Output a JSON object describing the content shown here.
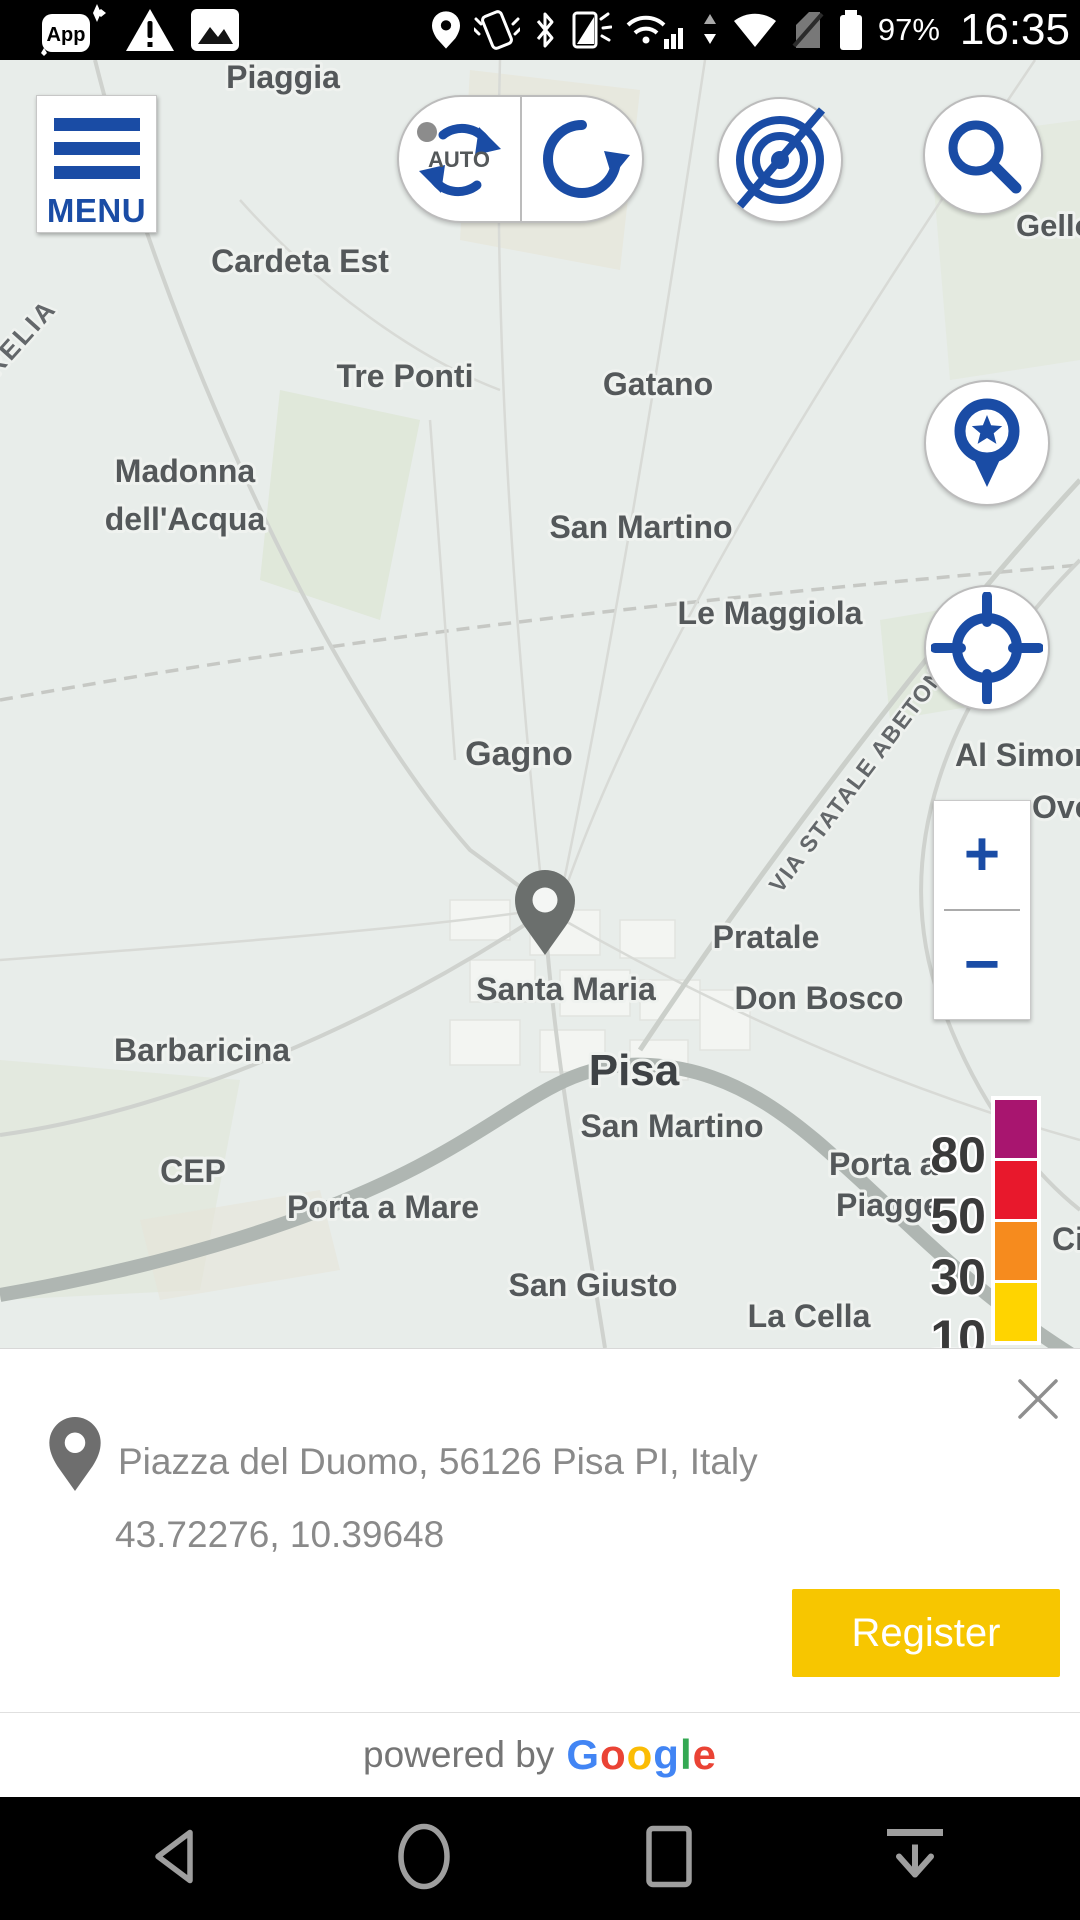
{
  "status_bar": {
    "time": "16:35",
    "battery_percent": "97%"
  },
  "map_controls": {
    "menu_label": "MENU",
    "auto_label": "AUTO",
    "zoom_in_label": "+",
    "zoom_out_label": "−"
  },
  "map": {
    "labels": [
      {
        "text": "Piaggia",
        "x": 283,
        "y": 28,
        "size": 32
      },
      {
        "text": "Gello",
        "x": 1016,
        "y": 176,
        "size": 31,
        "anchor": "start"
      },
      {
        "text": "Cardeta Est",
        "x": 300,
        "y": 212,
        "size": 32
      },
      {
        "text": "RELIA",
        "x": -4,
        "y": 318,
        "size": 26,
        "rotate": -48,
        "anchor": "start",
        "cls": "lbl-road",
        "spacing": "3"
      },
      {
        "text": "Tre Ponti",
        "x": 405,
        "y": 327,
        "size": 32
      },
      {
        "text": "Gatano",
        "x": 658,
        "y": 335,
        "size": 32
      },
      {
        "text": "Madonna",
        "x": 185,
        "y": 422,
        "size": 32
      },
      {
        "text": "dell'Acqua",
        "x": 185,
        "y": 470,
        "size": 32
      },
      {
        "text": "San Martino",
        "x": 641,
        "y": 478,
        "size": 32
      },
      {
        "text": "Le Maggiola",
        "x": 770,
        "y": 564,
        "size": 32
      },
      {
        "text": "Gagno",
        "x": 519,
        "y": 705,
        "size": 34
      },
      {
        "text": "VIA STATALE ABETONE",
        "x": 868,
        "y": 718,
        "size": 23,
        "rotate": -53,
        "cls": "lbl-road",
        "spacing": "1.5"
      },
      {
        "text": "Al Simon",
        "x": 955,
        "y": 706,
        "size": 32,
        "anchor": "start"
      },
      {
        "text": "Ovest",
        "x": 1032,
        "y": 758,
        "size": 32,
        "anchor": "start"
      },
      {
        "text": "Pratale",
        "x": 766,
        "y": 888,
        "size": 32
      },
      {
        "text": "Santa Maria",
        "x": 566,
        "y": 940,
        "size": 32
      },
      {
        "text": "Don Bosco",
        "x": 819,
        "y": 949,
        "size": 32
      },
      {
        "text": "Barbaricina",
        "x": 202,
        "y": 1001,
        "size": 32
      },
      {
        "text": "Pisa",
        "x": 634,
        "y": 1025,
        "size": 44,
        "cls": "lbl-city"
      },
      {
        "text": "San Martino",
        "x": 672,
        "y": 1077,
        "size": 32
      },
      {
        "text": "CEP",
        "x": 193,
        "y": 1122,
        "size": 32
      },
      {
        "text": "Porta a",
        "x": 829,
        "y": 1115,
        "size": 32,
        "anchor": "start"
      },
      {
        "text": "Piagge",
        "x": 836,
        "y": 1156,
        "size": 32,
        "anchor": "start"
      },
      {
        "text": "Porta a Mare",
        "x": 383,
        "y": 1158,
        "size": 32
      },
      {
        "text": "San Giusto",
        "x": 593,
        "y": 1236,
        "size": 32
      },
      {
        "text": "La Cella",
        "x": 809,
        "y": 1267,
        "size": 32
      },
      {
        "text": "Ci",
        "x": 1052,
        "y": 1190,
        "size": 32,
        "anchor": "start"
      }
    ]
  },
  "legend": {
    "items": [
      {
        "value": "80",
        "color": "#A8156F"
      },
      {
        "value": "50",
        "color": "#E8182C"
      },
      {
        "value": "30",
        "color": "#F68B1E"
      },
      {
        "value": "10",
        "color": "#FFD400"
      }
    ]
  },
  "info_panel": {
    "address": "Piazza del Duomo, 56126 Pisa PI, Italy",
    "coordinates": "43.72276, 10.39648",
    "register_label": "Register"
  },
  "footer": {
    "powered_by": "powered by",
    "google_letters": [
      {
        "ch": "G",
        "color": "#4285F4"
      },
      {
        "ch": "o",
        "color": "#EA4335"
      },
      {
        "ch": "o",
        "color": "#FBBC05"
      },
      {
        "ch": "g",
        "color": "#4285F4"
      },
      {
        "ch": "l",
        "color": "#34A853"
      },
      {
        "ch": "e",
        "color": "#EA4335"
      }
    ]
  }
}
